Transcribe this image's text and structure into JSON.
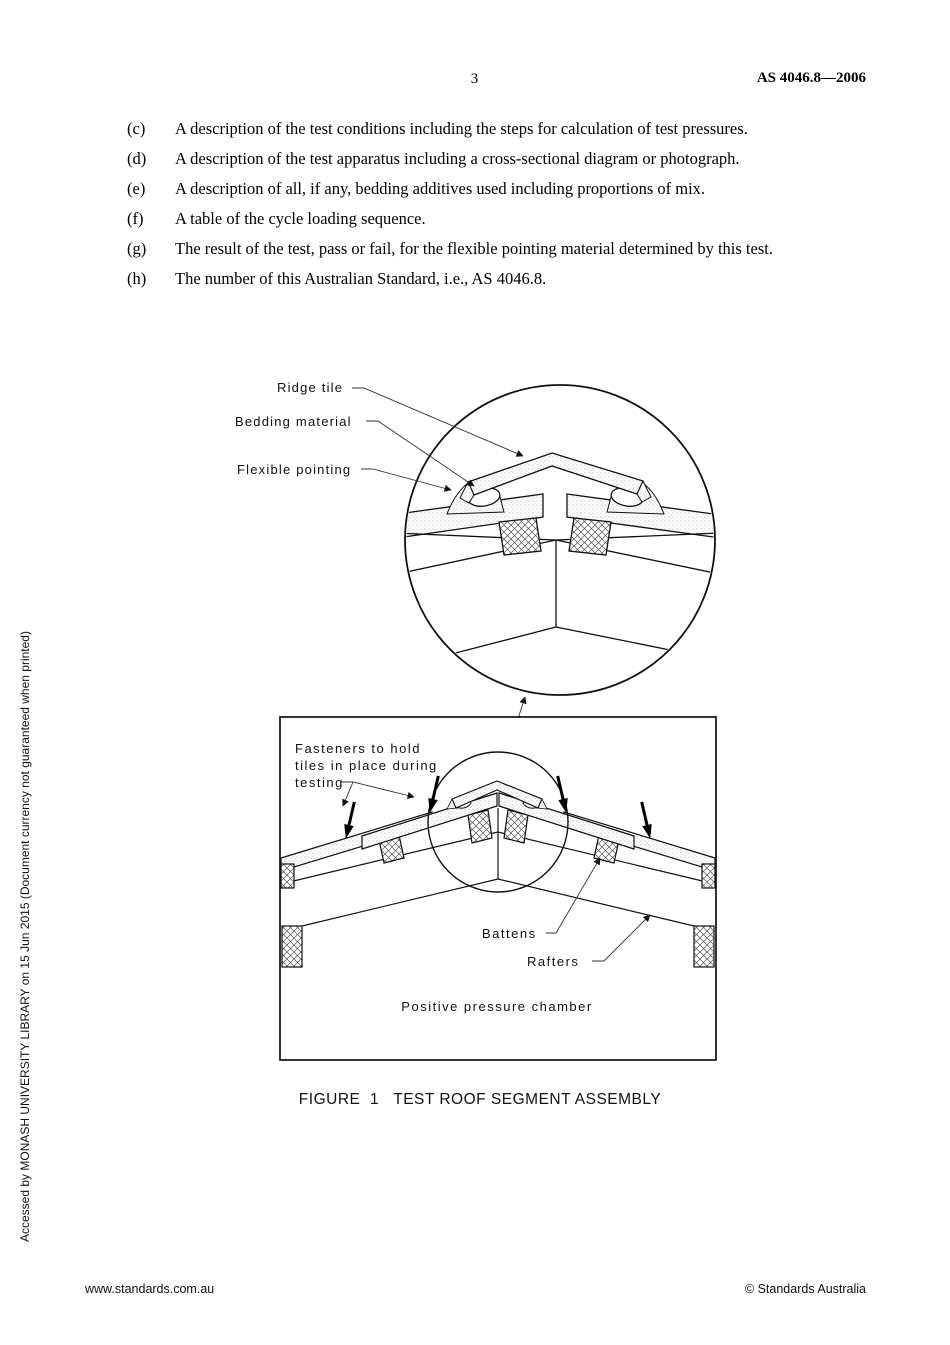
{
  "header": {
    "page_number": "3",
    "standard_code": "AS 4046.8—2006"
  },
  "list_items": [
    {
      "marker": "(c)",
      "text": "A description of the test conditions including the steps for calculation of test pressures."
    },
    {
      "marker": "(d)",
      "text": "A description of the test apparatus including a cross-sectional diagram or photograph."
    },
    {
      "marker": "(e)",
      "text": "A description of all, if any, bedding additives used including proportions of mix."
    },
    {
      "marker": "(f)",
      "text": "A table of the cycle loading sequence."
    },
    {
      "marker": "(g)",
      "text": "The result of the test, pass or fail, for the flexible pointing material determined by this test."
    },
    {
      "marker": "(h)",
      "text": "The number of this Australian Standard, i.e., AS 4046.8."
    }
  ],
  "figure": {
    "caption": "FIGURE  1   TEST ROOF SEGMENT ASSEMBLY",
    "detail_labels": {
      "ridge_tile": "Ridge tile",
      "bedding_material": "Bedding material",
      "flexible_pointing": "Flexible pointing"
    },
    "assembly_labels": {
      "fasteners_l1": "Fasteners to hold",
      "fasteners_l2": "tiles in place during",
      "fasteners_l3": "testing",
      "battens": "Battens",
      "rafters": "Rafters",
      "chamber": "Positive pressure chamber"
    }
  },
  "sidebar_note": "Accessed by MONASH UNIVERSITY LIBRARY on 15 Jun 2015 (Document currency not guaranteed when printed)",
  "footer": {
    "website": "www.standards.com.au",
    "copyright": "© Standards Australia"
  }
}
